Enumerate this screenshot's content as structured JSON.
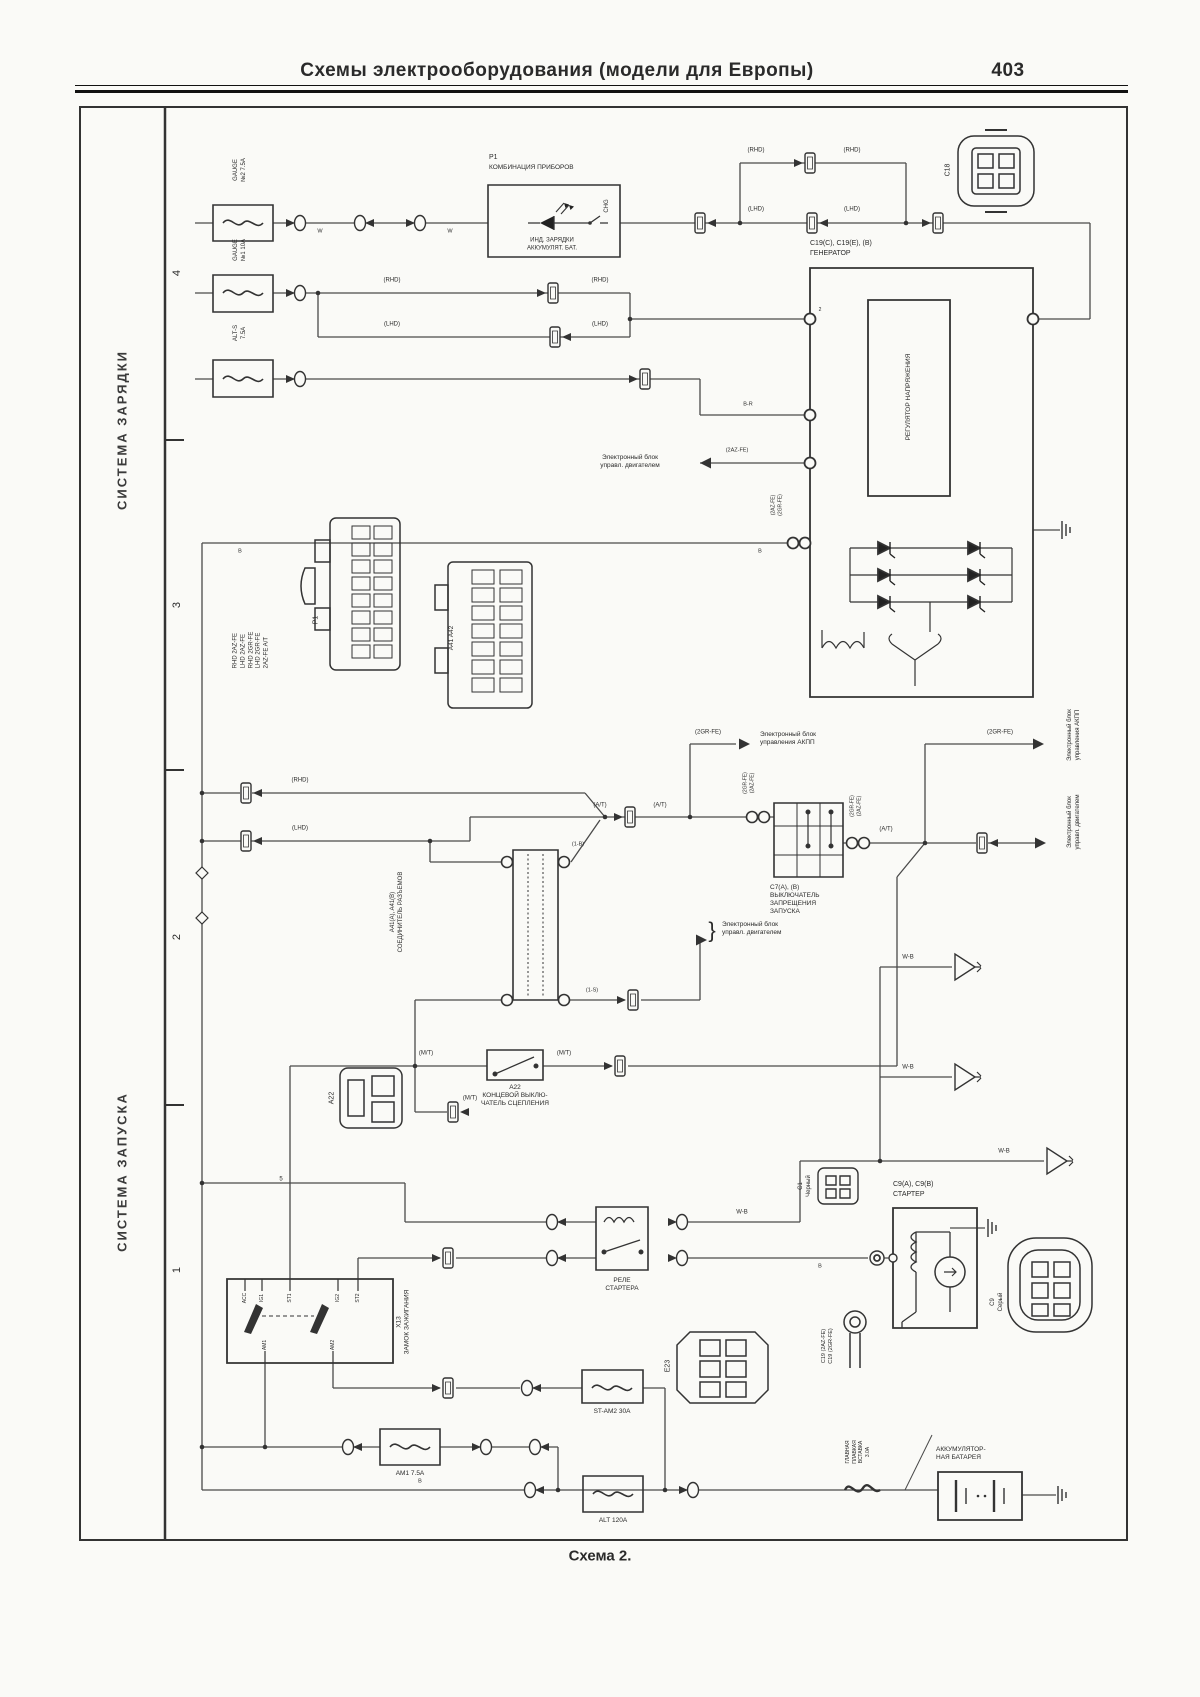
{
  "header": {
    "title": "Схемы электрооборудования (модели для Европы)",
    "page": "403"
  },
  "sidebar": {
    "charging": "СИСТЕМА ЗАРЯДКИ",
    "starting": "СИСТЕМА ЗАПУСКА",
    "sec4": "4",
    "sec3": "3",
    "sec2": "2",
    "sec1": "1"
  },
  "caption": "Схема 2.",
  "charging": {
    "fuse_gauge2": "GAUGE\n№2 7.5A",
    "fuse_gauge1": "GAUGE\n№1 10A",
    "fuse_alt_s": "ALT-S\n7.5A",
    "cluster_code": "P1",
    "cluster_name": "КОМБИНАЦИЯ ПРИБОРОВ",
    "cluster_ind": "ИНД. ЗАРЯДКИ\nАККУМУЛЯТ. БАТ.",
    "chg": "CHG",
    "c18": "C18",
    "gen_code": "C19(C), C19(E), (B)",
    "gen_name": "ГЕНЕРАТОР",
    "regulator": "РЕГУЛЯТОР НАПРЯЖЕНИЯ",
    "gen_pin2": "2",
    "gen_t_codes": "(2AZ-FE)\n(2GR-FE)",
    "rhd": "(RHD)",
    "lhd": "(LHD)",
    "w": "W",
    "b": "B",
    "br": "B-R",
    "azfe": "(2AZ-FE)"
  },
  "ecu_engine": "Электронный блок\nуправл. двигателем",
  "ecu_at": "Электронный блок\nуправления АКПП",
  "starting": {
    "legend": "RHD 2AZ-FE\nLHD 2AZ-FE\nRHD 2GR-FE\nLHD 2GR-FE\n2AZ-FE A/T",
    "p1": "P1",
    "a41a42": "A41 A42",
    "junction": "A41(A), A41(B)\nСОЕДИНИТЕЛЬ РАЗЪЕМОВ",
    "w_1b": "(1-B)",
    "w_1s": "(1-S)",
    "at": "(A/T)",
    "mt": "(M/T)",
    "grfe": "(2GR-FE)",
    "pnp_codes": "(2GR-FE)\n(2AZ-FE)",
    "pnp": "C7(A), (B)\nВЫКЛЮЧАТЕЛЬ\nЗАПРЕЩЕНИЯ\nЗАПУСКА",
    "clutch": "A22\nКОНЦЕВОЙ ВЫКЛЮ-\nЧАТЕЛЬ СЦЕПЛЕНИЯ",
    "a22": "A22",
    "relay": "РЕЛЕ\nСТАРТЕРА",
    "c1": "C1\nЧерный",
    "starter_code": "C9(A), C9(B)",
    "starter": "СТАРТЕР",
    "c9": "C9\nСерый",
    "x13": "X13\nЗАМОК ЗАЖИГАНИЯ",
    "acc": "ACC",
    "ig1": "IG1",
    "st1": "ST1",
    "ig2": "IG2",
    "st2": "ST2",
    "am1": "AM1",
    "am2": "AM2",
    "pin5": "5",
    "wb": "W-B",
    "fuse_stam2": "ST-AM2 30A",
    "fuse_am1": "AM1 7.5A",
    "fuse_alt": "ALT 120A",
    "main_link": "ГЛАВНАЯ\nПЛАВКАЯ\nВСТАВКА\n3.0A",
    "battery": "АККУМУЛЯТОР-\nНАЯ БАТАРЕЯ",
    "ring": "C19 (2AZ-FE)\nC19 (2GR-FE)",
    "e23": "E23",
    "brace": "}"
  }
}
